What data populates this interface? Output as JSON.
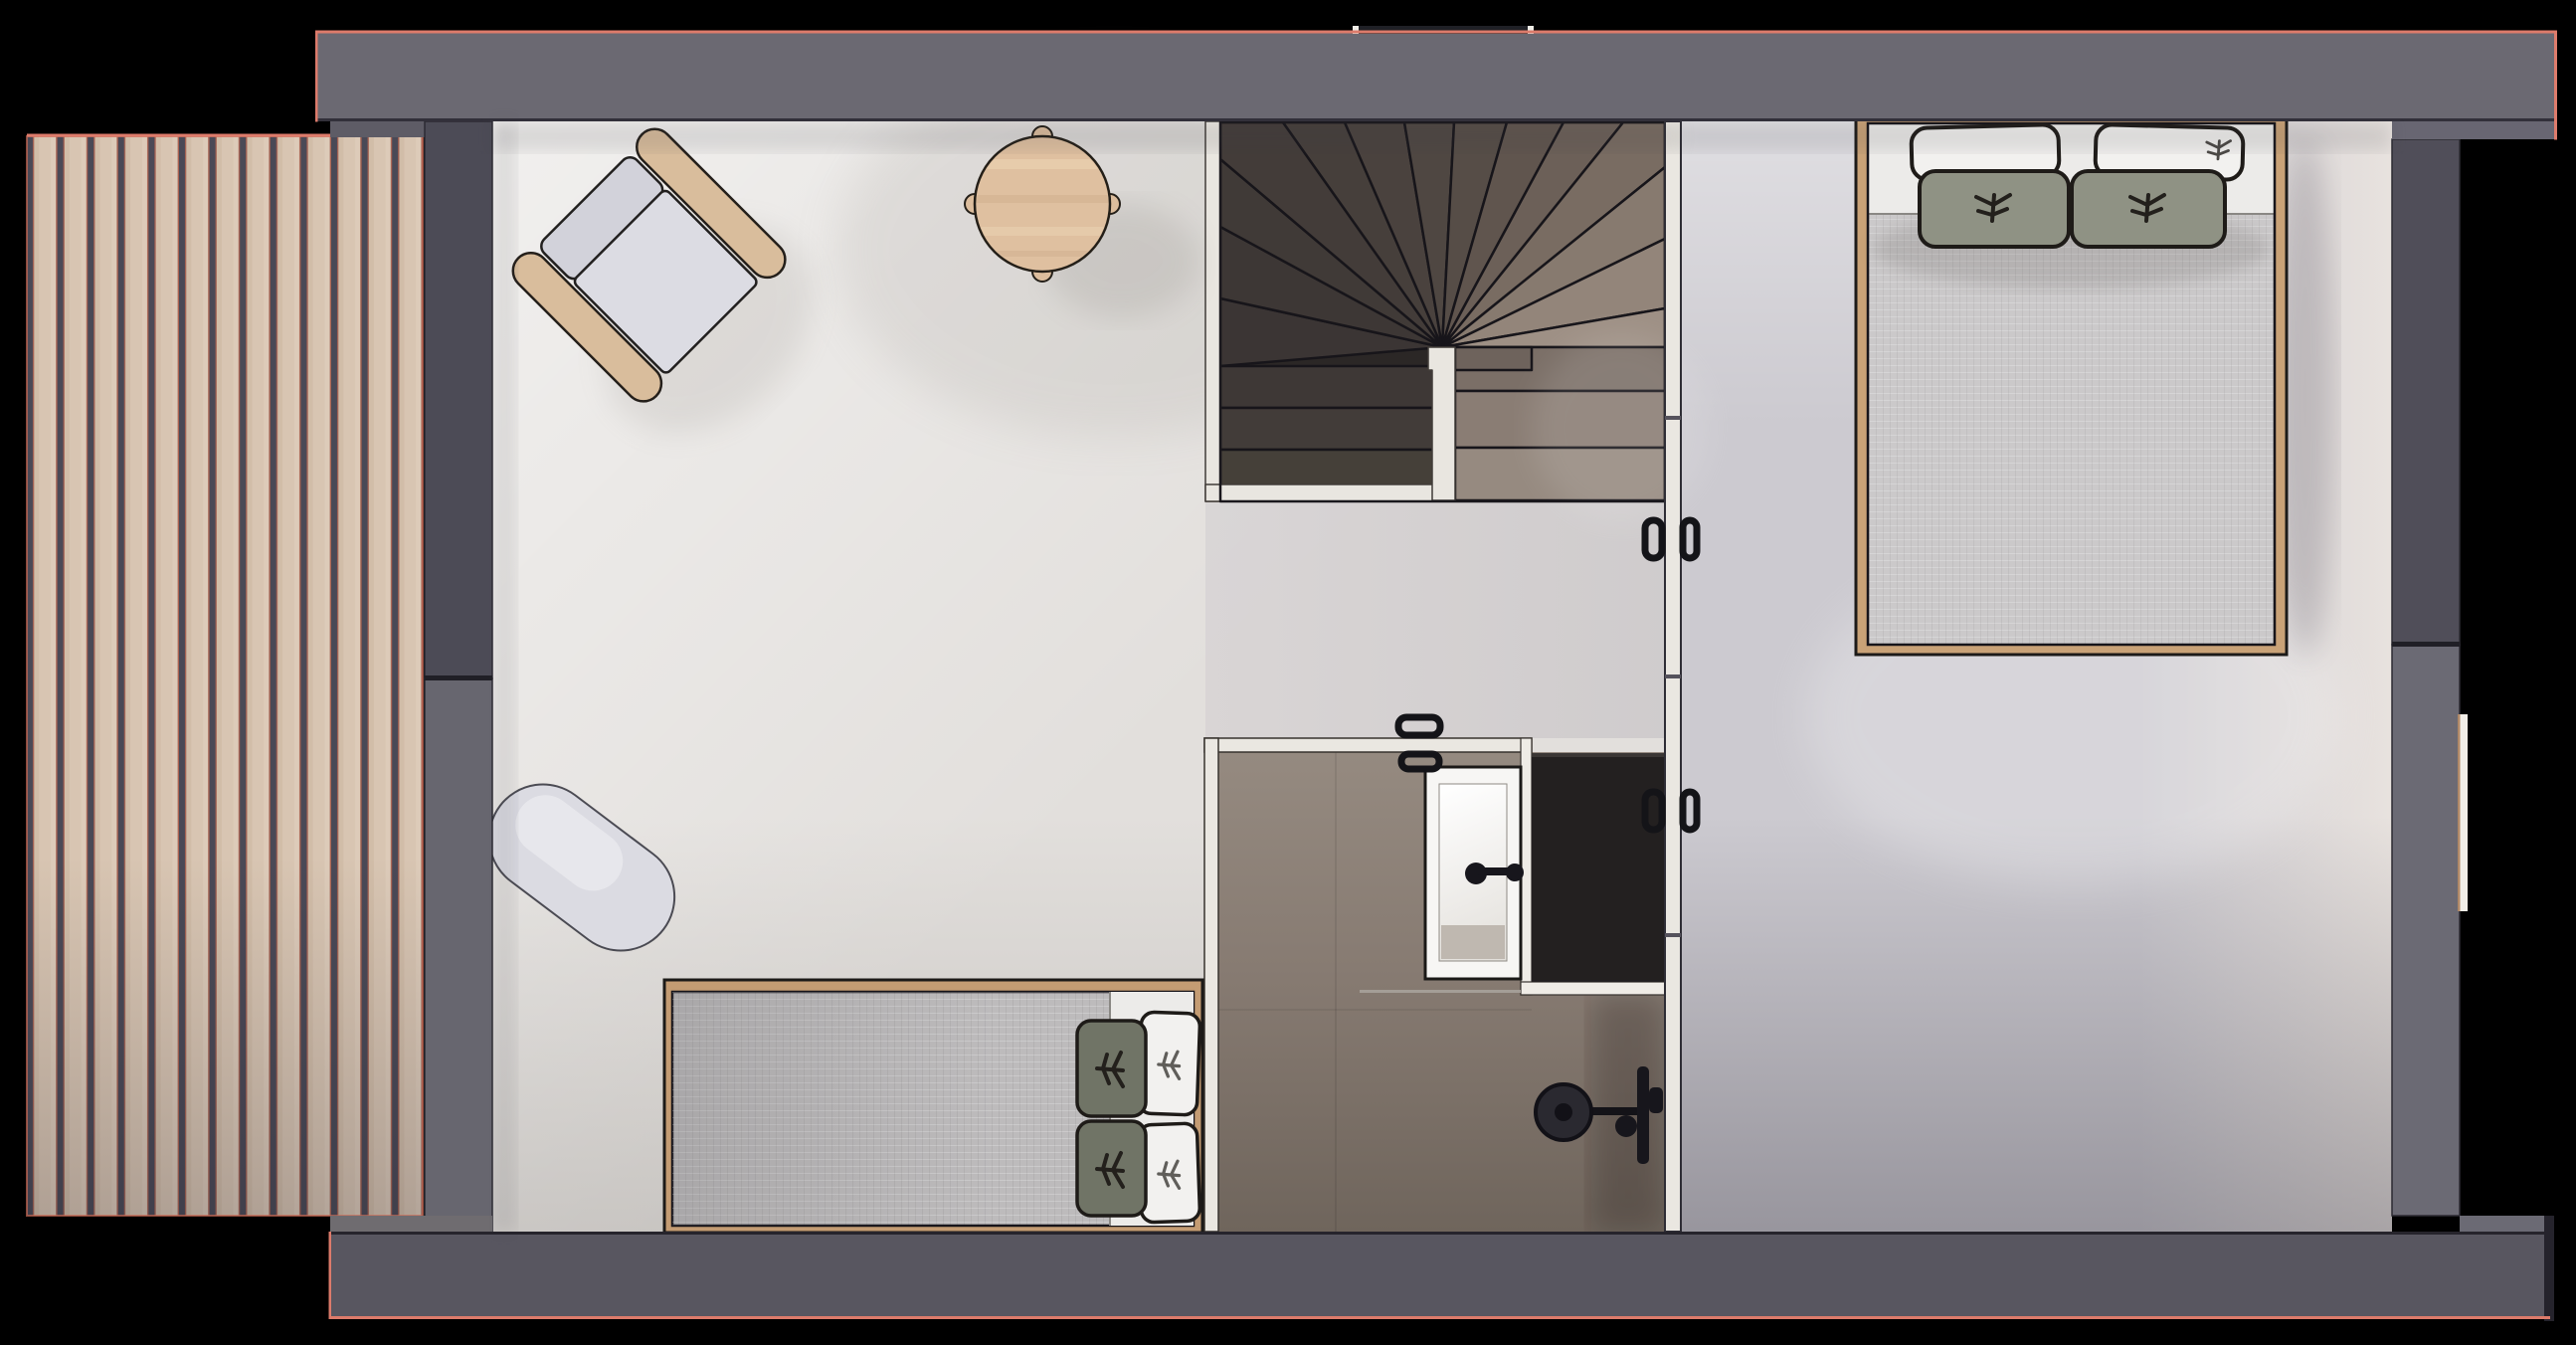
{
  "scene": {
    "kind": "architectural-floor-plan-render",
    "view": "top-down",
    "deck_plank_count": 13,
    "stair_winder_wedges": 14
  },
  "colors": {
    "background": "#000000",
    "salmon_outline": "#DD7B6B",
    "band_top": "#6B6972",
    "band_bottom": "#585660",
    "band_step": "#686672",
    "band_under_deck": "#6F6C70",
    "strip_above_deck": "#5E5C66",
    "wall_left_upper": "#4C4B56",
    "wall_left_lower": "#67666F",
    "wall_right_upper": "#504E59",
    "wall_right_lower": "#6B6A74",
    "wall_right_edge_dark": "#25232C",
    "wall_white": "#EAE7E1",
    "skylight_dark": "#1F2026",
    "floor_main": "#E2DFDC",
    "floor_hall": "#D5D2D3",
    "floor_bedroom": "#CCCAD0",
    "deck_plank": "#D8C5B2",
    "deck_gap": "#4A4956",
    "deck_edge_line": "#C2684F",
    "stair_bg": "#2B2726",
    "newel_white": "#E9E6E0",
    "stair_fan": [
      "#3B3534",
      "#3D3735",
      "#403A37",
      "#433C39",
      "#463F3B",
      "#4A423E",
      "#4F4742",
      "#564D47",
      "#60554E",
      "#6C6058",
      "#796C62",
      "#877A6F",
      "#93857A",
      "#9E9085"
    ],
    "stair_left_treads": [
      "#3E3836",
      "#423C39",
      "#454039"
    ],
    "stair_right_treads": [
      "#7B6F67",
      "#8A7D74",
      "#968A80"
    ],
    "stair_step_small": "#6E635C",
    "chair_back": "#D2D2DA",
    "chair_seat": "#DCDCE3",
    "chair_wood": "#D9BD9C",
    "table_wood": "#DFC0A0",
    "rug": "#DBDBE2",
    "bed_frame_double": "#C9A277",
    "bed_frame_single": "#C49C73",
    "duvet_double": "#CBC9CA",
    "duvet_single": "#BDBBBC",
    "sheet_white": "#ECEBE9",
    "pillow_white": "#F2F1EF",
    "pillow_sage": "#8F9284",
    "pillow_olive": "#707466",
    "bath_floor_mid": "#877B72",
    "sink_white": "#F7F6F4",
    "sink_basin_floor": "#BFB8B0",
    "shower_panel": "#232020",
    "fixture_black": "#17161C",
    "drain_line": "#A9A49E",
    "window_frame": "#F2EEE8"
  },
  "inventory": [
    {
      "id": "terrace-deck"
    },
    {
      "id": "living-area"
    },
    {
      "id": "stair-landing-hall"
    },
    {
      "id": "bedroom-right"
    },
    {
      "id": "bathroom"
    },
    {
      "id": "winder-staircase"
    },
    {
      "id": "armchair"
    },
    {
      "id": "round-side-table"
    },
    {
      "id": "oval-rug"
    },
    {
      "id": "single-bed"
    },
    {
      "id": "double-bed"
    },
    {
      "id": "shower-tray"
    },
    {
      "id": "shower-head"
    },
    {
      "id": "dark-vanity-panel"
    },
    {
      "id": "door-bedroom-handles"
    },
    {
      "id": "door-bathroom-handles"
    },
    {
      "id": "sliding-door-handles"
    },
    {
      "id": "window-right-wall"
    }
  ]
}
